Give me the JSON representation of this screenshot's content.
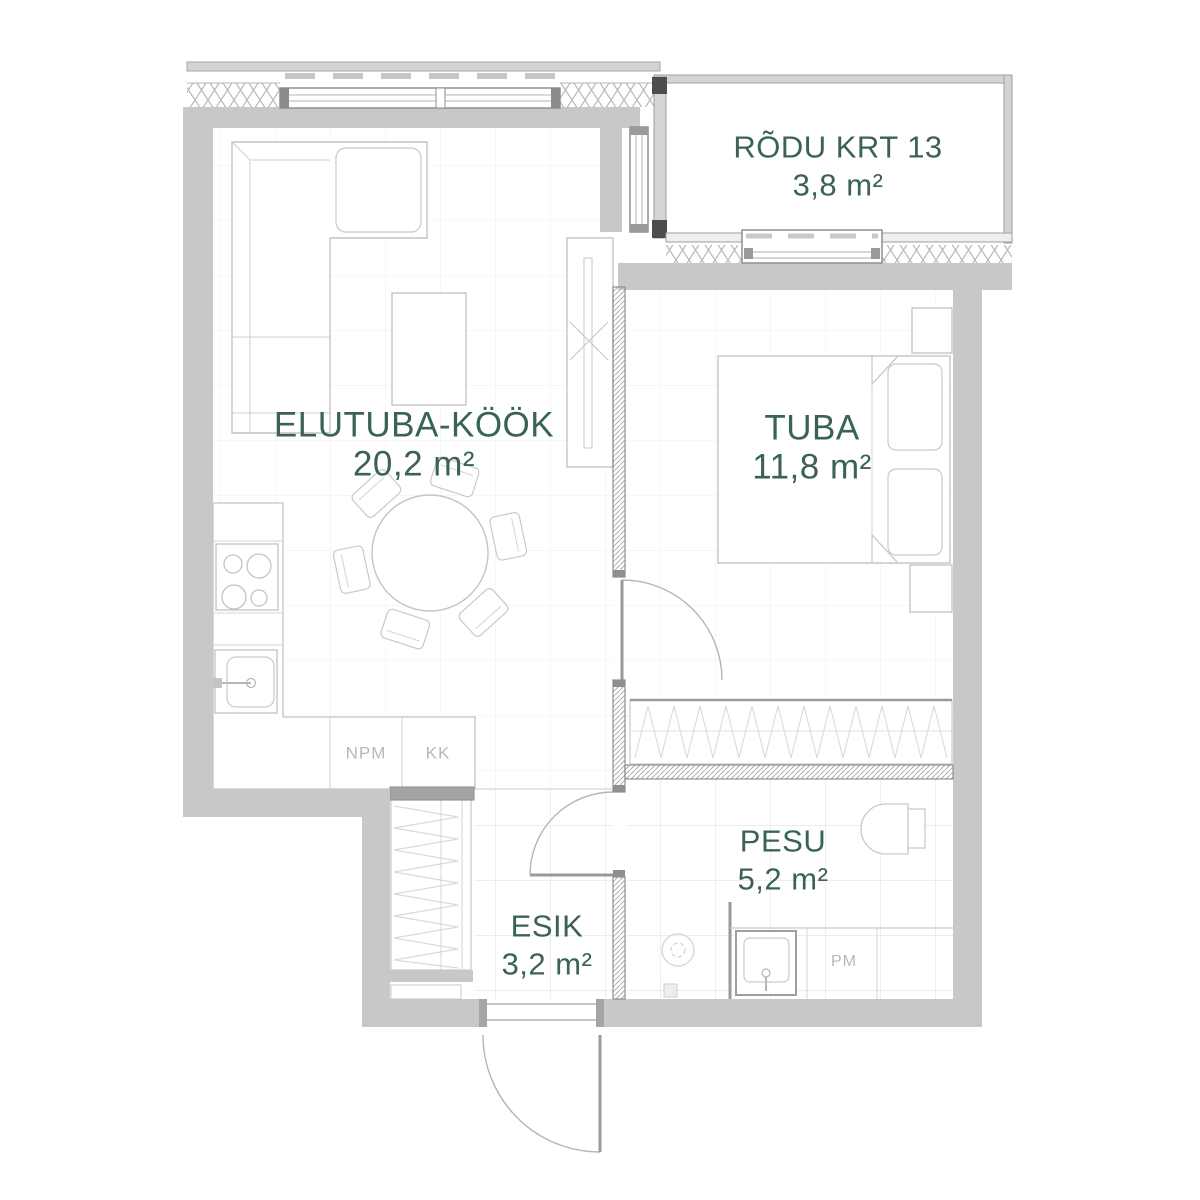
{
  "plan": {
    "colors": {
      "label": "#3a6354",
      "appliance_label": "#b8b8b8",
      "wall": "#c8c8c8",
      "partition_line": "#8f8f8f",
      "furniture_line": "#c4c4c4",
      "floor_tile_line": "#e2e2e2"
    },
    "rooms": [
      {
        "id": "rodu",
        "name": "RÕDU KRT 13",
        "area": "3,8 m²"
      },
      {
        "id": "elutuba",
        "name": "ELUTUBA-KÖÖK",
        "area": "20,2 m²"
      },
      {
        "id": "tuba",
        "name": "TUBA",
        "area": "11,8 m²"
      },
      {
        "id": "pesu",
        "name": "PESU",
        "area": "5,2 m²"
      },
      {
        "id": "esik",
        "name": "ESIK",
        "area": "3,2 m²"
      }
    ],
    "appliances": [
      {
        "id": "npm",
        "label": "NPM"
      },
      {
        "id": "kk",
        "label": "KK"
      },
      {
        "id": "pm",
        "label": "PM"
      }
    ]
  }
}
